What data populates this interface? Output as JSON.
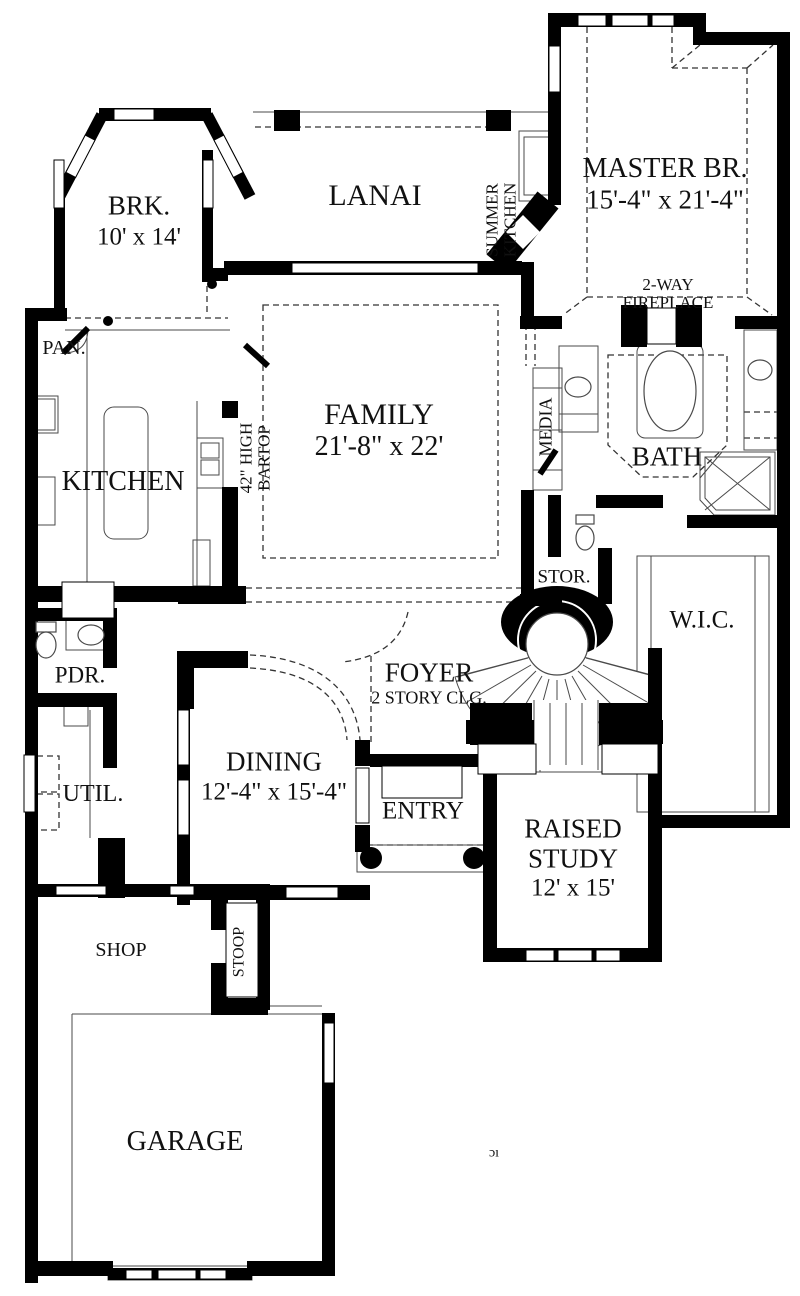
{
  "rooms": {
    "brk": {
      "name": "BRK.",
      "dims": "10' x 14'"
    },
    "lanai": {
      "name": "LANAI"
    },
    "summer_kitchen": {
      "line1": "SUMMER",
      "line2": "KITCHEN"
    },
    "master": {
      "name": "MASTER BR.",
      "dims": "15'-4\" x 21'-4\""
    },
    "fireplace": {
      "line1": "2-WAY",
      "line2": "FIREPLACE"
    },
    "pantry": {
      "name": "PAN."
    },
    "kitchen": {
      "name": "KITCHEN"
    },
    "bartop": {
      "line1": "42\" HIGH",
      "line2": "BARTOP"
    },
    "family": {
      "name": "FAMILY",
      "dims": "21'-8\" x 22'"
    },
    "media": {
      "name": "MEDIA"
    },
    "bath": {
      "name": "BATH"
    },
    "stor": {
      "name": "STOR."
    },
    "wic": {
      "name": "W.I.C."
    },
    "foyer": {
      "name": "FOYER",
      "note": "2 STORY CLG."
    },
    "pdr": {
      "name": "PDR."
    },
    "util": {
      "name": "UTIL."
    },
    "dining": {
      "name": "DINING",
      "dims": "12'-4\" x 15'-4\""
    },
    "entry": {
      "name": "ENTRY"
    },
    "study": {
      "line1": "RAISED",
      "line2": "STUDY",
      "dims": "12' x 15'"
    },
    "shop": {
      "name": "SHOP"
    },
    "stoop": {
      "name": "STOOP"
    },
    "garage": {
      "name": "GARAGE"
    },
    "partial_mark": "ɔı"
  },
  "colors": {
    "wall": "#000000",
    "thin_line": "#4a4a4a",
    "background": "#ffffff"
  }
}
